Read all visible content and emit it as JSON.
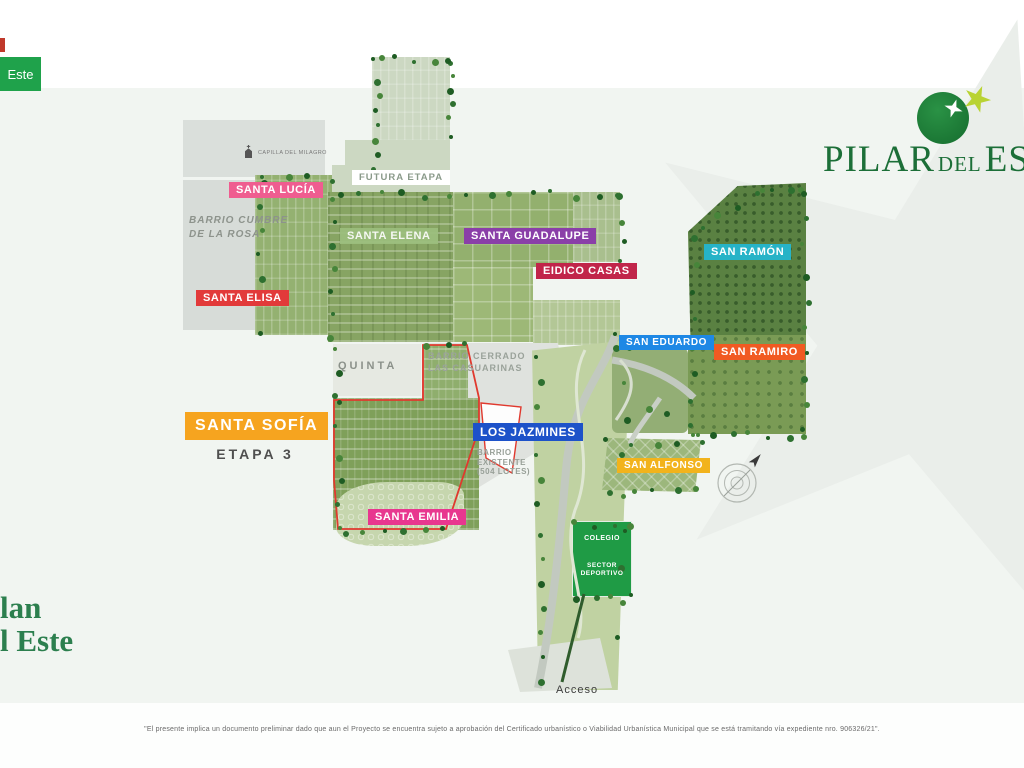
{
  "page": {
    "background": "#f1f5f1",
    "red_marker_color": "#c0392b",
    "top_button": {
      "label": "Este",
      "bg": "#1fa24b",
      "text_color": "#ffffff"
    },
    "disclaimer": "\"El presente implica un documento preliminar dado que aun el Proyecto se encuentra sujeto a aprobación del Certificado urbanístico o Viabilidad Urbanística Municipal que se está tramitando vía expediente nro. 906326/21\"."
  },
  "logo": {
    "word_pilar": "PILAR",
    "word_del": "DEL",
    "word_este": "ESTE",
    "text_color": "#1c6f38",
    "circle_color": "#1e8038",
    "star_white": "#ffffff",
    "star_yellow": "#b9d333"
  },
  "corner_text": {
    "line1": "lan",
    "line2": "l Este",
    "color": "#2c7f4e"
  },
  "map": {
    "labels": {
      "santa_lucia": {
        "text": "SANTA LUCÍA",
        "bg": "#ef5d90"
      },
      "santa_elena": {
        "text": "SANTA ELENA",
        "bg": "#9cbf7e"
      },
      "santa_guadalupe": {
        "text": "SANTA GUADALUPE",
        "bg": "#8a3fa8"
      },
      "eidico_casas": {
        "text": "EIDICO CASAS",
        "bg": "#c1254a"
      },
      "santa_elisa": {
        "text": "SANTA ELISA",
        "bg": "#e23a3a"
      },
      "santa_sofia": {
        "text": "SANTA SOFÍA",
        "bg": "#f6a41f",
        "subtitle": "ETAPA 3"
      },
      "santa_emilia": {
        "text": "SANTA EMILIA",
        "bg": "#e8378f"
      },
      "los_jazmines": {
        "text": "LOS JAZMINES",
        "bg": "#1d52c9",
        "sub_line1": "BARRIO",
        "sub_line2": "EXISTENTE",
        "sub_line3": "(504 LOTES)"
      },
      "san_ramon": {
        "text": "SAN RAMÓN",
        "bg": "#26b3c7"
      },
      "san_eduardo": {
        "text": "SAN EDUARDO",
        "bg": "#1e88e5"
      },
      "san_ramiro": {
        "text": "SAN RAMIRO",
        "bg": "#f15a22"
      },
      "san_alfonso": {
        "text": "SAN ALFONSO",
        "bg": "#f2b31c"
      },
      "futura_etapa": {
        "text": "FUTURA ETAPA",
        "bg": "#ffffff",
        "color": "#8a9a8a"
      }
    },
    "areas": {
      "quinta": "QUINTA",
      "casuarinas_line1": "BARRIO CERRADO",
      "casuarinas_line2": "LAS CASUARINAS",
      "cumbre_line1": "BARRIO CUMBRE",
      "cumbre_line2": "DE LA ROSA",
      "capilla": "CAPILLA DEL MILAGRO",
      "colegio": "COLEGIO",
      "sector_line1": "SECTOR",
      "sector_line2": "DEPORTIVO",
      "acceso": "Acceso"
    }
  }
}
